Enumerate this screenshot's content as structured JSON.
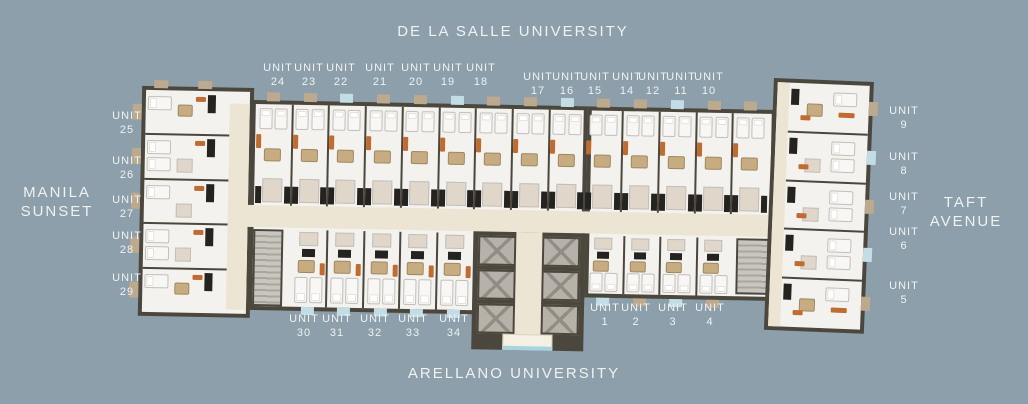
{
  "surroundings": {
    "north": "DE LA SALLE UNIVERSITY",
    "south": "ARELLANO UNIVERSITY",
    "west_line1": "MANILA",
    "west_line2": "SUNSET",
    "east_line1": "TAFT",
    "east_line2": "AVENUE"
  },
  "unit_word": "UNIT",
  "units": [
    {
      "word": "UNIT",
      "number": "24",
      "x": 278,
      "y": 62
    },
    {
      "word": "UNIT",
      "number": "23",
      "x": 309,
      "y": 62
    },
    {
      "word": "UNIT",
      "number": "22",
      "x": 341,
      "y": 62
    },
    {
      "word": "UNIT",
      "number": "21",
      "x": 380,
      "y": 62
    },
    {
      "word": "UNIT",
      "number": "20",
      "x": 416,
      "y": 62
    },
    {
      "word": "UNIT",
      "number": "19",
      "x": 448,
      "y": 62
    },
    {
      "word": "UNIT",
      "number": "18",
      "x": 481,
      "y": 62
    },
    {
      "word": "UNIT",
      "number": "17",
      "x": 538,
      "y": 71
    },
    {
      "word": "UNIT",
      "number": "16",
      "x": 567,
      "y": 71
    },
    {
      "word": "UNIT",
      "number": "15",
      "x": 595,
      "y": 71
    },
    {
      "word": "UNIT",
      "number": "14",
      "x": 627,
      "y": 71
    },
    {
      "word": "UNIT",
      "number": "12",
      "x": 653,
      "y": 71
    },
    {
      "word": "UNIT",
      "number": "11",
      "x": 681,
      "y": 71
    },
    {
      "word": "UNIT",
      "number": "10",
      "x": 709,
      "y": 71
    },
    {
      "word": "UNIT",
      "number": "25",
      "x": 127,
      "y": 110
    },
    {
      "word": "UNIT",
      "number": "26",
      "x": 127,
      "y": 155
    },
    {
      "word": "UNIT",
      "number": "27",
      "x": 127,
      "y": 194
    },
    {
      "word": "UNIT",
      "number": "28",
      "x": 127,
      "y": 230
    },
    {
      "word": "UNIT",
      "number": "29",
      "x": 127,
      "y": 272
    },
    {
      "word": "UNIT",
      "number": "9",
      "x": 904,
      "y": 105
    },
    {
      "word": "UNIT",
      "number": "8",
      "x": 904,
      "y": 151
    },
    {
      "word": "UNIT",
      "number": "7",
      "x": 904,
      "y": 191
    },
    {
      "word": "UNIT",
      "number": "6",
      "x": 904,
      "y": 226
    },
    {
      "word": "UNIT",
      "number": "5",
      "x": 904,
      "y": 280
    },
    {
      "word": "UNIT",
      "number": "30",
      "x": 304,
      "y": 313
    },
    {
      "word": "UNIT",
      "number": "31",
      "x": 337,
      "y": 313
    },
    {
      "word": "UNIT",
      "number": "32",
      "x": 375,
      "y": 313
    },
    {
      "word": "UNIT",
      "number": "33",
      "x": 413,
      "y": 313
    },
    {
      "word": "UNIT",
      "number": "34",
      "x": 454,
      "y": 313
    },
    {
      "word": "UNIT",
      "number": "1",
      "x": 605,
      "y": 302
    },
    {
      "word": "UNIT",
      "number": "2",
      "x": 636,
      "y": 302
    },
    {
      "word": "UNIT",
      "number": "3",
      "x": 673,
      "y": 302
    },
    {
      "word": "UNIT",
      "number": "4",
      "x": 710,
      "y": 302
    }
  ],
  "colors": {
    "bg": "#8C9FAA",
    "text": "#F0F2F1",
    "wall": "#4B473D",
    "floor": "#F3F2EF",
    "floor_bright": "#F8F7F5",
    "corridor": "#EDE5D3",
    "bath": "#E0D6C9",
    "wood": "#C8AC81",
    "orange": "#C06C31",
    "dark": "#24231F",
    "lift": "#B6B2A9",
    "lift_x": "#918D84",
    "stairs_light": "#C9C6BF",
    "stairs_dark": "#A9A59D",
    "tab_tan": "#BCA98E",
    "tab_blue": "#C2DDE5",
    "canopy": "#F5F0E4",
    "canopy_blue": "#A8D4E0",
    "bed_border": "#C2BFB8"
  }
}
